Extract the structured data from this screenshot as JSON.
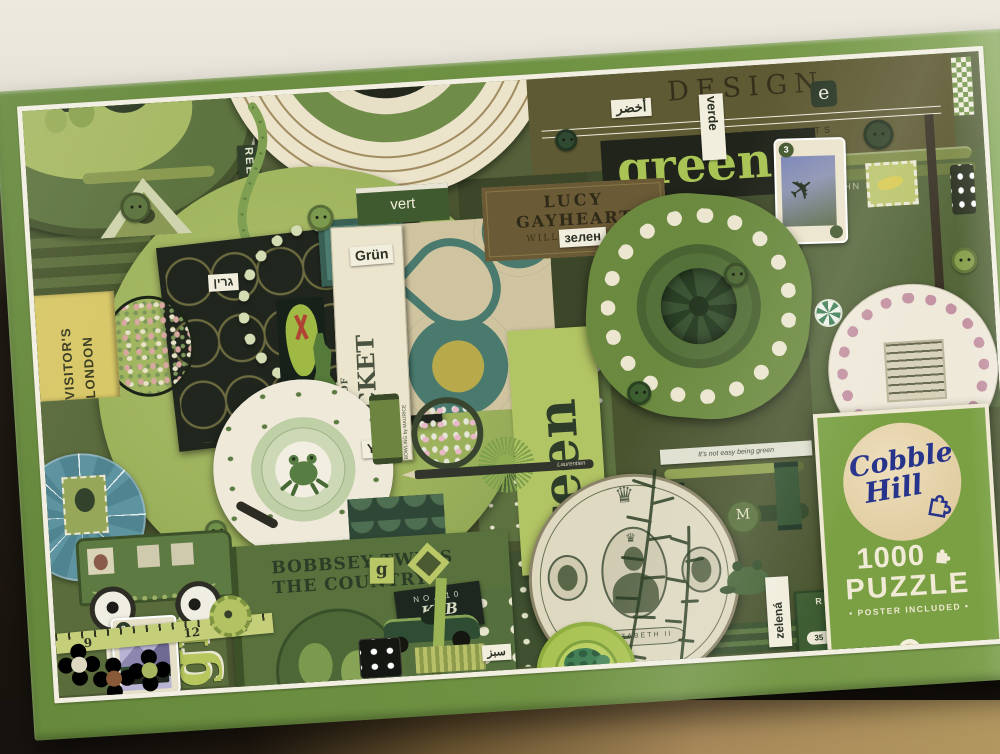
{
  "panel": {
    "brand_line1": "Cobble",
    "brand_line2": "Hill",
    "piece_count": "1000",
    "product_word": "PUZZLE",
    "tagline": "• POSTER INCLUDED •"
  },
  "labels": {
    "design": "DESIGN",
    "industrial_arts": "INDUSTRIAL ARTS",
    "john_kyle": "JOHN KYLE",
    "green_headline": "green",
    "green_panel": "green",
    "green_chunky": "green",
    "verde": "verde",
    "vert": "vert",
    "grun": "Grün",
    "yesil": "Yeşil",
    "zielony": "Zielony",
    "zelena": "zelená",
    "zelen": "зелен",
    "grin_hebrew": "גרין",
    "prasino": "πράσινο",
    "akhdar": "أخضر",
    "sabz": "سبز",
    "midori": "緑",
    "visitors_line1": "VISITOR'S",
    "visitors_line2": "LONDON",
    "lucy_line1": "LUCY",
    "lucy_line2": "GAYHEART",
    "lucy_author": "WILLA CATHER",
    "cricket_small": "THE GAME OF",
    "cricket_big": "CRICKET",
    "cricket_sub": "AS IT SHOULD BE PLAYED",
    "cricket_author": "by JACK HOBBS",
    "cricket_author2": "BOWLING by MAURICE",
    "bobbsey_line1": "BOBBSEY TWINS",
    "bobbsey_line2": "THE COUNTRY",
    "reeves": "REEVES",
    "laurentien": "Laurentien",
    "elizabeth": "ELIZABETH II",
    "kab_no": "NO. 10",
    "kab": "KAB",
    "ruban": "RUBAN",
    "ruban_price": "35",
    "ruban_cents": "15¢",
    "quote": "It's not easy being green",
    "card_three": "3",
    "card_eight": "8",
    "tape_nine": "9",
    "tape_twelve": "12",
    "tape_thirteen": "13",
    "letter_e": "e",
    "letter_e2": "e",
    "letter_m": "M",
    "letter_g": "g"
  }
}
